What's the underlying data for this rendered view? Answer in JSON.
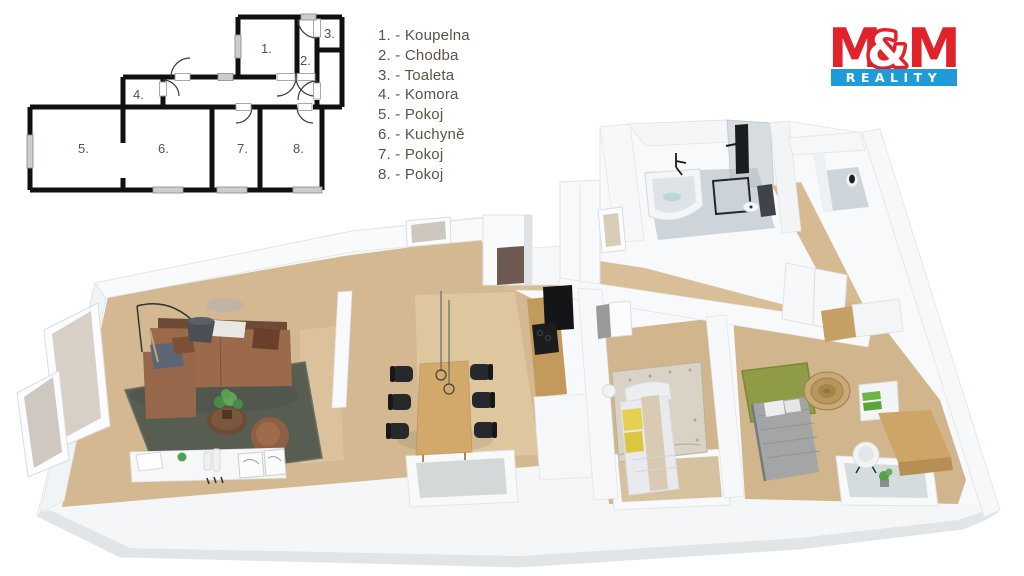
{
  "legend": {
    "items": [
      "1. - Koupelna",
      "2. - Chodba",
      "3. - Toaleta",
      "4. - Komora",
      "5. - Pokoj",
      "6. - Kuchyně",
      "7. - Pokoj",
      "8. - Pokoj"
    ]
  },
  "plan2d": {
    "labels": [
      "1.",
      "2.",
      "3.",
      "4.",
      "5.",
      "6.",
      "7.",
      "8."
    ]
  },
  "logo": {
    "m_left": "M",
    "ampersand": "&",
    "m_right": "M",
    "reality": "REALITY",
    "colors": {
      "red": "#e0232a",
      "blue": "#1f9bd7",
      "white": "#ffffff"
    }
  },
  "palette": {
    "legend_text": "#5c5247",
    "wall_black": "#101010",
    "floor_wood": "#d3b892",
    "wall_white": "#f8fafb",
    "rug_living": "#585d52",
    "sofa_brown": "#9a6a4a",
    "dining_wood": "#d3a86b",
    "chair_black": "#26292c",
    "bed_yellow": "#e5d14f",
    "bed_gray": "#a3a5a7",
    "rug_green": "#8f9c45",
    "bath_floor": "#ced5da"
  }
}
